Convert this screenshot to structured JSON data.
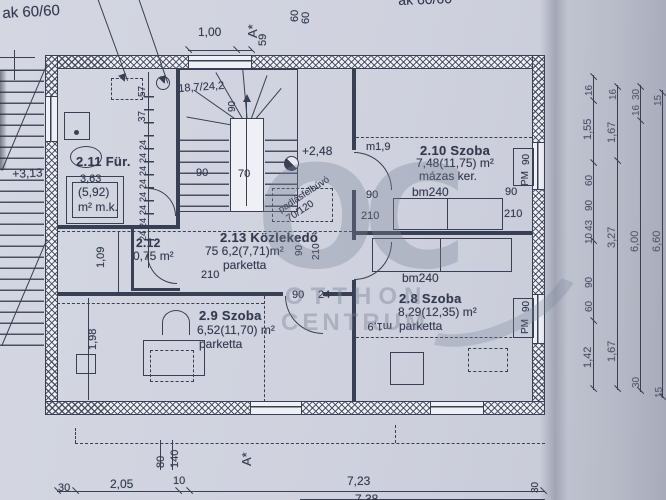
{
  "watermark": {
    "logo": "OC",
    "line1": "OTTHON",
    "line2": "CENTRUM"
  },
  "plan": {
    "labels": [
      {
        "n": "note-wall-top-left",
        "t": "ak 60/60",
        "x": 2,
        "y": 6,
        "r": -3,
        "s": 15
      },
      {
        "n": "note-wall-top-right",
        "t": "ak 60/60",
        "x": 398,
        "y": -7,
        "r": -2,
        "s": 14
      },
      {
        "n": "dim-top-1-00",
        "t": "1,00",
        "x": 198,
        "y": 26,
        "r": 0,
        "s": 12
      },
      {
        "n": "section-marker-a-top",
        "t": "A*",
        "x": 246,
        "y": 38,
        "r": -90,
        "s": 13
      },
      {
        "n": "dim-top-59",
        "t": "59",
        "x": 258,
        "y": 46,
        "r": -90,
        "s": 11
      },
      {
        "n": "dim-top-60a",
        "t": "60",
        "x": 290,
        "y": 22,
        "r": -90,
        "s": 11
      },
      {
        "n": "dim-top-60b",
        "t": "60",
        "x": 301,
        "y": 24,
        "r": -90,
        "s": 11
      },
      {
        "n": "level-plus-3-13",
        "t": "+3,13",
        "x": 12,
        "y": 168,
        "r": -3,
        "s": 12
      },
      {
        "n": "room-2-11-title",
        "t": "2.11 Für.",
        "x": 76,
        "y": 155,
        "r": 0,
        "s": 13,
        "b": 1
      },
      {
        "n": "room-2-11-area1",
        "t": "3,63",
        "x": 80,
        "y": 174,
        "r": 0,
        "s": 11
      },
      {
        "n": "room-2-11-area2",
        "t": "(5,92)",
        "x": 78,
        "y": 186,
        "r": 0,
        "s": 12
      },
      {
        "n": "room-2-11-floor",
        "t": "m² m.k.",
        "x": 78,
        "y": 201,
        "r": 0,
        "s": 12
      },
      {
        "n": "dim-left-57",
        "t": "57",
        "x": 138,
        "y": 97,
        "r": -90,
        "s": 10
      },
      {
        "n": "dim-left-37",
        "t": "37",
        "x": 138,
        "y": 122,
        "r": -90,
        "s": 10
      },
      {
        "n": "dim-left-24-1",
        "t": "24",
        "x": 139,
        "y": 150,
        "r": -90,
        "s": 9
      },
      {
        "n": "dim-left-24-2",
        "t": "24",
        "x": 139,
        "y": 163,
        "r": -90,
        "s": 9
      },
      {
        "n": "dim-left-24-3",
        "t": "24",
        "x": 139,
        "y": 176,
        "r": -90,
        "s": 9
      },
      {
        "n": "dim-left-24-4",
        "t": "24",
        "x": 139,
        "y": 189,
        "r": -90,
        "s": 9
      },
      {
        "n": "dim-left-24-5",
        "t": "24",
        "x": 139,
        "y": 202,
        "r": -90,
        "s": 9
      },
      {
        "n": "dim-left-24-6",
        "t": "24",
        "x": 139,
        "y": 215,
        "r": -90,
        "s": 9
      },
      {
        "n": "dim-left-24-7",
        "t": "24",
        "x": 139,
        "y": 228,
        "r": -90,
        "s": 9
      },
      {
        "n": "dim-left-24-8",
        "t": "24",
        "x": 139,
        "y": 241,
        "r": -90,
        "s": 9
      },
      {
        "n": "stair-step-note",
        "t": "18,7/24,2",
        "x": 178,
        "y": 84,
        "r": -4,
        "s": 11
      },
      {
        "n": "stair-dim-90-top",
        "t": "90",
        "x": 228,
        "y": 112,
        "r": -90,
        "s": 10
      },
      {
        "n": "level-plus-2-48",
        "t": "+2,48",
        "x": 302,
        "y": 145,
        "r": 0,
        "s": 12
      },
      {
        "n": "stair-dim-90",
        "t": "90",
        "x": 196,
        "y": 168,
        "r": 0,
        "s": 11
      },
      {
        "n": "stair-dim-70",
        "t": "70",
        "x": 238,
        "y": 169,
        "r": 0,
        "s": 11
      },
      {
        "n": "attic-hatch-note",
        "t": "padlásfelbúvó",
        "x": 277,
        "y": 207,
        "r": -33,
        "s": 9.5
      },
      {
        "n": "attic-hatch-size",
        "t": "70/120",
        "x": 285,
        "y": 216,
        "r": -33,
        "s": 10
      },
      {
        "n": "room-2-13-title",
        "t": "2.13 Közlekedő",
        "x": 220,
        "y": 231,
        "r": 0,
        "s": 13,
        "b": 1
      },
      {
        "n": "room-2-13-area",
        "t": "75 6,2(7,71)m²",
        "x": 205,
        "y": 245,
        "r": 0,
        "s": 12
      },
      {
        "n": "room-2-13-floor",
        "t": "parketta",
        "x": 223,
        "y": 259,
        "r": 0,
        "s": 12
      },
      {
        "n": "room-2-13-h210",
        "t": "210",
        "x": 201,
        "y": 270,
        "r": 0,
        "s": 11
      },
      {
        "n": "door-2-13-90",
        "t": "90",
        "x": 295,
        "y": 256,
        "r": -90,
        "s": 10
      },
      {
        "n": "door-2-13-210",
        "t": "210",
        "x": 312,
        "y": 260,
        "r": -90,
        "s": 10
      },
      {
        "n": "height-m19-210",
        "t": "m1,9",
        "x": 366,
        "y": 142,
        "r": 0,
        "s": 11
      },
      {
        "n": "room-2-10-title",
        "t": "2.10 Szoba",
        "x": 420,
        "y": 144,
        "r": 0,
        "s": 13,
        "b": 1
      },
      {
        "n": "room-2-10-area",
        "t": "7,48(11,75) m²",
        "x": 416,
        "y": 157,
        "r": 0,
        "s": 12
      },
      {
        "n": "room-2-10-floor",
        "t": "mázas ker.",
        "x": 419,
        "y": 170,
        "r": 0,
        "s": 12
      },
      {
        "n": "bed-2-10-bm240",
        "t": "bm240",
        "x": 412,
        "y": 186,
        "r": 0,
        "s": 12
      },
      {
        "n": "door-2-10-90",
        "t": "90",
        "x": 366,
        "y": 190,
        "r": 0,
        "s": 11
      },
      {
        "n": "door-2-10-210",
        "t": "210",
        "x": 361,
        "y": 211,
        "r": 0,
        "s": 11
      },
      {
        "n": "win-2-10-90",
        "t": "90",
        "x": 505,
        "y": 187,
        "r": 0,
        "s": 11
      },
      {
        "n": "win-2-10-210",
        "t": "210",
        "x": 504,
        "y": 209,
        "r": 0,
        "s": 11
      },
      {
        "n": "win-2-10-90r",
        "t": "90",
        "x": 522,
        "y": 165,
        "r": -90,
        "s": 10
      },
      {
        "n": "win-2-10-pm",
        "t": "PM",
        "x": 521,
        "y": 186,
        "r": -90,
        "s": 10
      },
      {
        "n": "bed-2-8-bm240",
        "t": "bm240",
        "x": 402,
        "y": 272,
        "r": 0,
        "s": 12
      },
      {
        "n": "room-2-8-title",
        "t": "2.8  Szoba",
        "x": 399,
        "y": 292,
        "r": 0,
        "s": 13,
        "b": 1
      },
      {
        "n": "room-2-8-area",
        "t": "8,29(12,35) m²",
        "x": 398,
        "y": 306,
        "r": 0,
        "s": 12
      },
      {
        "n": "room-2-8-floor",
        "t": "parketta",
        "x": 399,
        "y": 320,
        "r": 0,
        "s": 12
      },
      {
        "n": "height-m19-2-8",
        "t": "m1,9",
        "x": 392,
        "y": 331,
        "r": 180,
        "s": 11
      },
      {
        "n": "win-2-8-90r",
        "t": "90",
        "x": 522,
        "y": 312,
        "r": -90,
        "s": 10
      },
      {
        "n": "win-2-8-pm",
        "t": "PM",
        "x": 521,
        "y": 334,
        "r": -90,
        "s": 10
      },
      {
        "n": "door-2-9-90",
        "t": "90",
        "x": 292,
        "y": 290,
        "r": 0,
        "s": 11
      },
      {
        "n": "door-2-9-24",
        "t": "24",
        "x": 318,
        "y": 290,
        "r": 0,
        "s": 11
      },
      {
        "n": "room-2-9-title",
        "t": "2.9 Szoba",
        "x": 199,
        "y": 309,
        "r": 0,
        "s": 13,
        "b": 1
      },
      {
        "n": "room-2-9-area",
        "t": "6,52(11,70) m²",
        "x": 197,
        "y": 324,
        "r": 0,
        "s": 12
      },
      {
        "n": "room-2-9-floor",
        "t": "parketta",
        "x": 199,
        "y": 338,
        "r": 0,
        "s": 12
      },
      {
        "n": "room-2-12-title",
        "t": "2.12",
        "x": 136,
        "y": 237,
        "r": 0,
        "s": 12,
        "b": 1
      },
      {
        "n": "room-2-12-area",
        "t": "0,75 m²",
        "x": 133,
        "y": 250,
        "r": 0,
        "s": 12
      },
      {
        "n": "dim-1-09",
        "t": "1,09",
        "x": 96,
        "y": 268,
        "r": -90,
        "s": 11
      },
      {
        "n": "dim-1-98",
        "t": "1,98",
        "x": 88,
        "y": 350,
        "r": -90,
        "s": 11
      },
      {
        "n": "dim-bottom-80",
        "t": "80",
        "x": 156,
        "y": 468,
        "r": -90,
        "s": 11
      },
      {
        "n": "dim-bottom-140",
        "t": "140",
        "x": 170,
        "y": 468,
        "r": -90,
        "s": 11
      },
      {
        "n": "section-marker-a-bottom",
        "t": "A*",
        "x": 240,
        "y": 466,
        "r": -90,
        "s": 13
      },
      {
        "n": "dim-bottom-30l",
        "t": "30",
        "x": 58,
        "y": 483,
        "r": 0,
        "s": 11
      },
      {
        "n": "dim-bottom-2-05",
        "t": "2,05",
        "x": 110,
        "y": 478,
        "r": 0,
        "s": 12
      },
      {
        "n": "dim-bottom-10",
        "t": "10",
        "x": 173,
        "y": 476,
        "r": 0,
        "s": 11
      },
      {
        "n": "dim-bottom-7-23",
        "t": "7,23",
        "x": 347,
        "y": 475,
        "r": 0,
        "s": 12
      },
      {
        "n": "dim-bottom-30r",
        "t": "30",
        "x": 531,
        "y": 493,
        "r": -90,
        "s": 10
      },
      {
        "n": "dim-bottom-7-38",
        "t": "7,38",
        "x": 355,
        "y": 493,
        "r": 0,
        "s": 12
      },
      {
        "n": "rdim-a-16",
        "t": "16",
        "x": 585,
        "y": 96,
        "r": -90,
        "s": 10
      },
      {
        "n": "rdim-a-1-55",
        "t": "1,55",
        "x": 583,
        "y": 140,
        "r": -90,
        "s": 11
      },
      {
        "n": "rdim-a-60a",
        "t": "60",
        "x": 585,
        "y": 186,
        "r": -90,
        "s": 10
      },
      {
        "n": "rdim-a-90a",
        "t": "90",
        "x": 585,
        "y": 211,
        "r": -90,
        "s": 10
      },
      {
        "n": "rdim-a-43",
        "t": "43",
        "x": 585,
        "y": 231,
        "r": -90,
        "s": 10
      },
      {
        "n": "rdim-a-10",
        "t": "10",
        "x": 585,
        "y": 244,
        "r": -90,
        "s": 10
      },
      {
        "n": "rdim-a-90b",
        "t": "90",
        "x": 585,
        "y": 288,
        "r": -90,
        "s": 10
      },
      {
        "n": "rdim-a-60b",
        "t": "60",
        "x": 585,
        "y": 312,
        "r": -90,
        "s": 10
      },
      {
        "n": "rdim-a-1-42",
        "t": "1,42",
        "x": 583,
        "y": 368,
        "r": -90,
        "s": 11
      },
      {
        "n": "rdim-b-16",
        "t": "16",
        "x": 609,
        "y": 100,
        "r": -90,
        "s": 10
      },
      {
        "n": "rdim-b-1-67a",
        "t": "1,67",
        "x": 607,
        "y": 143,
        "r": -90,
        "s": 11
      },
      {
        "n": "rdim-b-3-27",
        "t": "3,27",
        "x": 607,
        "y": 248,
        "r": -90,
        "s": 11
      },
      {
        "n": "rdim-b-1-67b",
        "t": "1,67",
        "x": 607,
        "y": 362,
        "r": -90,
        "s": 11
      },
      {
        "n": "rdim-c-30",
        "t": "30",
        "x": 632,
        "y": 100,
        "r": -90,
        "s": 10
      },
      {
        "n": "rdim-c-16",
        "t": "16",
        "x": 632,
        "y": 116,
        "r": -90,
        "s": 10
      },
      {
        "n": "rdim-c-6-00",
        "t": "6,00",
        "x": 630,
        "y": 252,
        "r": -90,
        "s": 11
      },
      {
        "n": "rdim-c-30b",
        "t": "30",
        "x": 632,
        "y": 388,
        "r": -90,
        "s": 10
      },
      {
        "n": "rdim-d-15",
        "t": "15",
        "x": 654,
        "y": 106,
        "r": -90,
        "s": 10
      },
      {
        "n": "rdim-d-6-60",
        "t": "6,60",
        "x": 652,
        "y": 252,
        "r": -90,
        "s": 11
      },
      {
        "n": "rdim-d-15b",
        "t": "15",
        "x": 655,
        "y": 398,
        "r": -90,
        "s": 10
      }
    ]
  }
}
